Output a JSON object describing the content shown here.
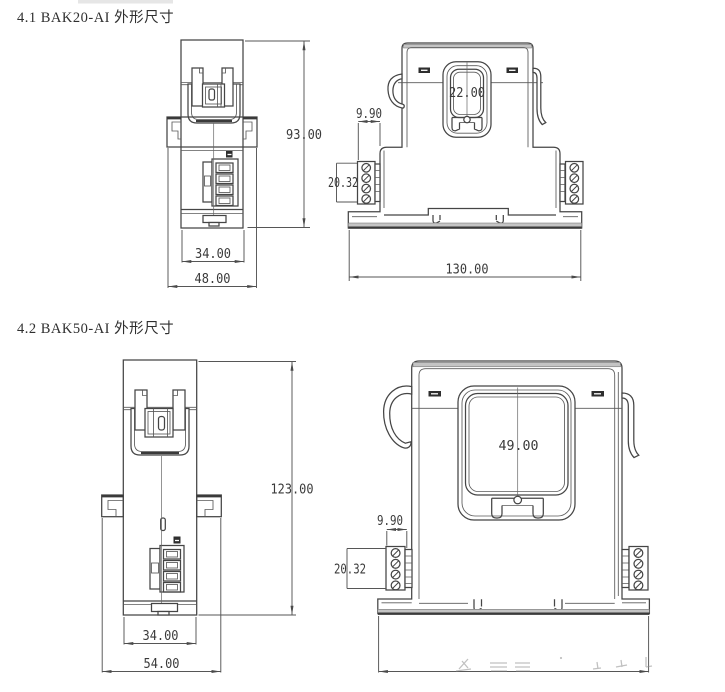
{
  "sections": [
    {
      "title": "4.1 BAK20-AI 外形尺寸",
      "side": {
        "height": "93.00",
        "body_width": "34.00",
        "overall_width": "48.00"
      },
      "front": {
        "aperture_width": "22.00",
        "terminal_depth": "9.90",
        "terminal_height": "20.32",
        "base_width": "130.00"
      }
    },
    {
      "title": "4.2 BAK50-AI 外形尺寸",
      "side": {
        "height": "123.00",
        "body_width": "34.00",
        "overall_width": "54.00"
      },
      "front": {
        "aperture_width": "49.00",
        "terminal_depth": "9.90",
        "terminal_height": "20.32",
        "base_width": ""
      }
    }
  ],
  "notes": {
    "bak50_base_dimension": "illegible faded watermark above bottom dimension line"
  },
  "colors": {
    "background": "#ffffff",
    "line": "#454545",
    "dimension": "#565656",
    "dim_text": "#3a3a3a",
    "title_text": "#2f2f2f",
    "shade": "#c4c4c4"
  }
}
